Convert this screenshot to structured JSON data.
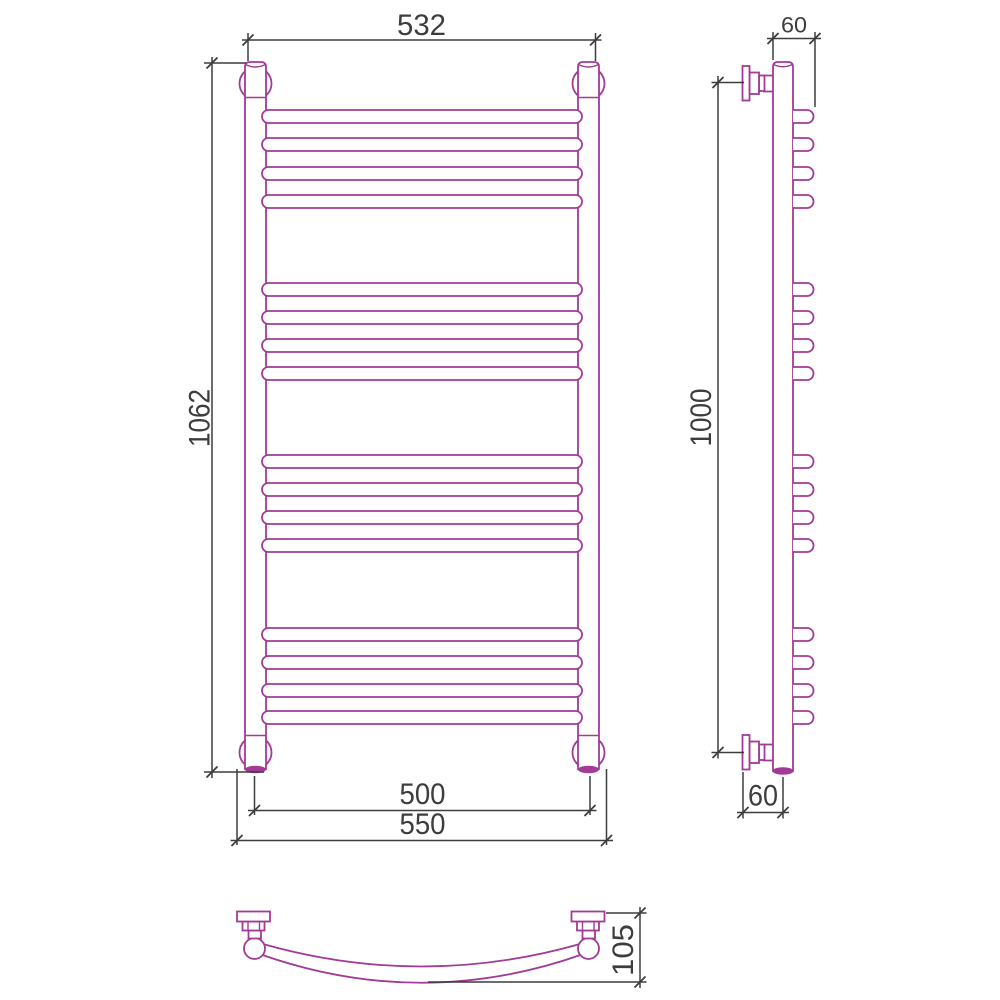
{
  "drawing": {
    "kind": "towel-rail-technical-drawing",
    "colors": {
      "line": "#A23A97",
      "dimension": "#3D3D3D",
      "background": "#FFFFFF"
    },
    "dimensions": {
      "front_width_top": "532",
      "front_height": "1062",
      "front_rail_width": "500",
      "front_overall_width": "550",
      "side_depth_top": "60",
      "side_height": "1000",
      "side_depth_bottom": "60",
      "plan_depth": "105"
    },
    "rungs": {
      "groups": 4,
      "per_group": 4,
      "total": 16,
      "height": 13,
      "y_tops": [
        110,
        138,
        167,
        195,
        283,
        311,
        339,
        367,
        455,
        483,
        511,
        539,
        628,
        656,
        684,
        711
      ]
    }
  }
}
